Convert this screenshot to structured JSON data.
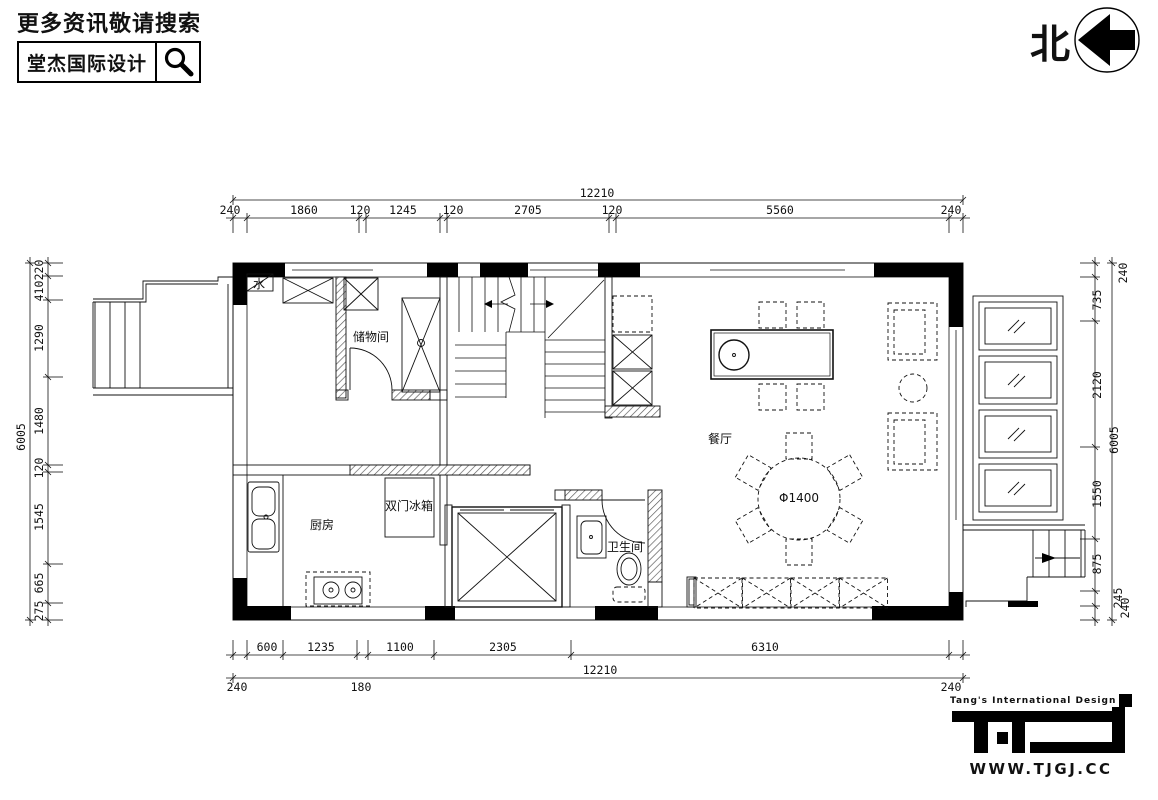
{
  "header": {
    "search_prompt": "更多资讯敬请搜索",
    "brand": "堂杰国际设计"
  },
  "compass": {
    "north_label": "北"
  },
  "plan": {
    "rooms": {
      "storage": "储物间",
      "kitchen": "厨房",
      "bathroom": "卫生间",
      "dining": "餐厅"
    },
    "annotations": {
      "fridge": "双门冰箱",
      "water_meter": "水",
      "table_diameter": "Φ1400"
    }
  },
  "dimensions": {
    "top": {
      "overall": "12210",
      "segments": [
        "240",
        "1860",
        "120",
        "1245",
        "120",
        "2705",
        "120",
        "5560",
        "240"
      ]
    },
    "bottom": {
      "overall": "12210",
      "segments": [
        "600",
        "1235",
        "1100",
        "2305",
        "6310"
      ],
      "outer": [
        "240",
        "180",
        "240"
      ]
    },
    "left": {
      "overall": "6005",
      "segments": [
        "220",
        "410",
        "1290",
        "1480",
        "120",
        "1545",
        "665",
        "275"
      ]
    },
    "right": {
      "overall": "6005",
      "segments": [
        "240",
        "735",
        "2120",
        "1550",
        "875",
        "245",
        "240"
      ]
    }
  },
  "footer": {
    "tagline": "Tang's International Design",
    "logo_text": "TID",
    "website": "WWW.TJGJ.CC"
  }
}
